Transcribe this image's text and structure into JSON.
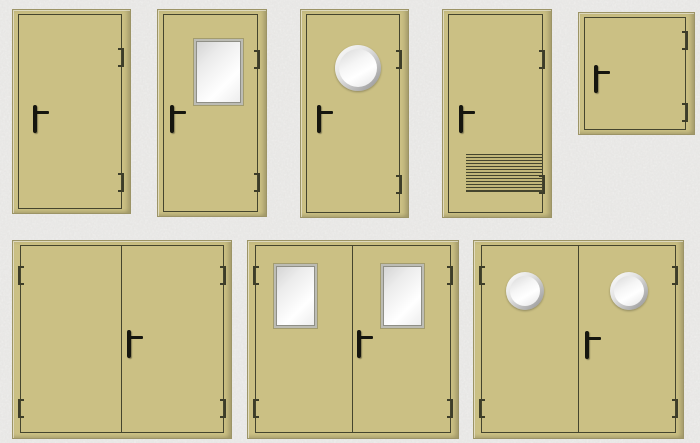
{
  "page": {
    "background_color": "#e6e5e3",
    "content": "catalog of technical metal doors, 8 variants, no visible text"
  },
  "palette": {
    "door_fill": "#cbc084",
    "door_frame_edge": "#9c9466",
    "leaf_outline": "#45452e",
    "handle_color": "#16160f",
    "hinge_color": "#3d3d29",
    "window_frame": "#bcbcb4",
    "glass_light": "#ffffff",
    "glass_dark": "#d3d3d3",
    "porthole_ring": "#909090",
    "grille_line": "#45452e"
  },
  "doors": [
    {
      "id": "single-leaf-plain",
      "type": "single-door",
      "x": 12,
      "y": 9,
      "w": 117,
      "h": 203,
      "leaf": {
        "l": 5,
        "t": 4,
        "r": 8,
        "b": 4
      },
      "handle": {
        "x": 20,
        "y": 95
      },
      "hinges": [
        {
          "side": "right",
          "y": 38
        },
        {
          "side": "right",
          "y": 163
        }
      ]
    },
    {
      "id": "single-leaf-glazed",
      "type": "single-door-with-window",
      "x": 157,
      "y": 9,
      "w": 108,
      "h": 206,
      "leaf": {
        "l": 5,
        "t": 4,
        "r": 8,
        "b": 4
      },
      "handle": {
        "x": 12,
        "y": 95
      },
      "windows": [
        {
          "x": 36,
          "y": 29,
          "w": 45,
          "h": 62
        }
      ],
      "hinges": [
        {
          "side": "right",
          "y": 40
        },
        {
          "side": "right",
          "y": 163
        }
      ]
    },
    {
      "id": "single-leaf-porthole",
      "type": "single-door-with-porthole",
      "x": 300,
      "y": 9,
      "w": 107,
      "h": 207,
      "leaf": {
        "l": 5,
        "t": 4,
        "r": 8,
        "b": 4
      },
      "handle": {
        "x": 16,
        "y": 95
      },
      "portholes": [
        {
          "x": 34,
          "y": 35,
          "d": 46
        }
      ],
      "hinges": [
        {
          "side": "right",
          "y": 40
        },
        {
          "side": "right",
          "y": 165
        }
      ]
    },
    {
      "id": "single-leaf-vent-grille",
      "type": "single-door-with-ventilation-grille",
      "x": 442,
      "y": 9,
      "w": 108,
      "h": 207,
      "leaf": {
        "l": 5,
        "t": 4,
        "r": 8,
        "b": 4
      },
      "handle": {
        "x": 16,
        "y": 95
      },
      "grille": {
        "x": 23,
        "y": 144,
        "w": 76,
        "h": 37
      },
      "hinges": [
        {
          "side": "right",
          "y": 40
        },
        {
          "side": "right",
          "y": 165
        }
      ]
    },
    {
      "id": "service-hatch",
      "type": "square-service-hatch",
      "x": 578,
      "y": 12,
      "w": 115,
      "h": 121,
      "leaf": {
        "l": 5,
        "t": 4,
        "r": 8,
        "b": 4
      },
      "handle": {
        "x": 15,
        "y": 52
      },
      "hinges": [
        {
          "side": "right",
          "y": 18
        },
        {
          "side": "right",
          "y": 90
        }
      ]
    },
    {
      "id": "double-leaf-plain",
      "type": "double-door",
      "x": 12,
      "y": 240,
      "w": 218,
      "h": 197,
      "leaves": 2,
      "leaf": {
        "l": 7,
        "t": 4,
        "r": 7,
        "b": 5
      },
      "handle": {
        "x": 114,
        "y": 89
      },
      "hinges": [
        {
          "side": "left",
          "y": 25
        },
        {
          "side": "left",
          "y": 158
        },
        {
          "side": "right",
          "y": 25
        },
        {
          "side": "right",
          "y": 158
        }
      ]
    },
    {
      "id": "double-leaf-glazed",
      "type": "double-door-with-windows",
      "x": 247,
      "y": 240,
      "w": 210,
      "h": 197,
      "leaves": 2,
      "leaf": {
        "l": 7,
        "t": 4,
        "r": 7,
        "b": 5
      },
      "handle": {
        "x": 109,
        "y": 89
      },
      "windows": [
        {
          "x": 26,
          "y": 23,
          "w": 39,
          "h": 60
        },
        {
          "x": 133,
          "y": 23,
          "w": 39,
          "h": 60
        }
      ],
      "hinges": [
        {
          "side": "left",
          "y": 25
        },
        {
          "side": "left",
          "y": 158
        },
        {
          "side": "right",
          "y": 25
        },
        {
          "side": "right",
          "y": 158
        }
      ]
    },
    {
      "id": "double-leaf-porthole",
      "type": "double-door-with-portholes",
      "x": 473,
      "y": 240,
      "w": 209,
      "h": 197,
      "leaves": 2,
      "leaf": {
        "l": 7,
        "t": 4,
        "r": 7,
        "b": 5
      },
      "handle": {
        "x": 111,
        "y": 90
      },
      "portholes": [
        {
          "x": 32,
          "y": 31,
          "d": 38
        },
        {
          "x": 136,
          "y": 31,
          "d": 38
        }
      ],
      "hinges": [
        {
          "side": "left",
          "y": 25
        },
        {
          "side": "left",
          "y": 158
        },
        {
          "side": "right",
          "y": 25
        },
        {
          "side": "right",
          "y": 158
        }
      ]
    }
  ]
}
